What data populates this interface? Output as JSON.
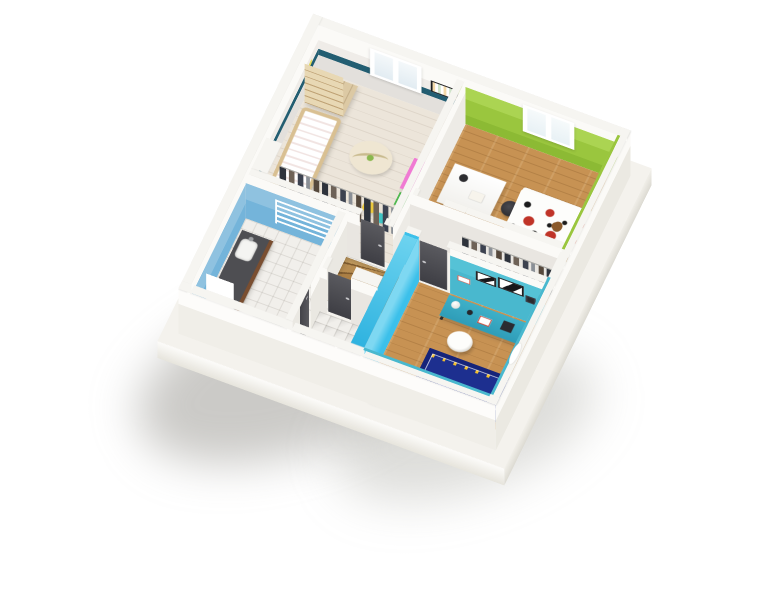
{
  "scene": {
    "title": "3D floor plan — upper floor",
    "background": "#ffffff",
    "projection": "axonometric top-down",
    "windows_visible": 2,
    "doors_visible": 5
  },
  "palette": {
    "wall_top_white": "#f6f5f1",
    "wall_grey": "#e3e0dc",
    "teal_stripe": "#235e72",
    "green_wall": "#a3cd45",
    "cyan_wall": "#3cc0ea",
    "bath_blue_wall": "#74b4da",
    "turquoise_wall": "#49b8ce",
    "oak_floor": "#c79253",
    "whitewash_floor": "#ece5da",
    "tile_floor": "#efede9",
    "door_dark": "#4b4b50",
    "stair_wood": "#a87b42",
    "rug_navy": "#1d2f8f",
    "bed_green": "#b8e49a",
    "toy_pink": "#e54fc4"
  },
  "rooms": [
    {
      "id": "nursery",
      "label": "Nursery (teal stripe walls)",
      "floor": "whitewashed wood",
      "furniture": [
        "corner wardrobe",
        "crib",
        "play gym mat",
        "pink toy chest",
        "green toy box",
        "two stools",
        "open closet with clothes"
      ]
    },
    {
      "id": "bedroom-green",
      "label": "Bedroom — green wall",
      "floor": "oak",
      "furniture": [
        "white desk",
        "black desk chair",
        "white storage shelf",
        "single bed with red-black floral duvet",
        "teddy bear",
        "white nightstand"
      ]
    },
    {
      "id": "bedroom-turquoise",
      "label": "Bedroom — turquoise walls",
      "floor": "oak",
      "furniture": [
        "open closet with clothes",
        "turquoise desk",
        "white lamp",
        "picture frames",
        "white tub chair",
        "navy play rug",
        "green single bed",
        "teddy bear",
        "oval wall mirror"
      ]
    },
    {
      "id": "bathroom",
      "label": "Bathroom — blue wall",
      "floor": "white tile",
      "furniture": [
        "dark vanity with sink",
        "towel radiator",
        "bathtub"
      ]
    },
    {
      "id": "wc",
      "label": "WC",
      "floor": "white tile",
      "furniture": [
        "toilet"
      ]
    },
    {
      "id": "hallway",
      "label": "Landing",
      "floor": "white tile",
      "furniture": [
        "winder staircase",
        "dark doors"
      ]
    }
  ]
}
